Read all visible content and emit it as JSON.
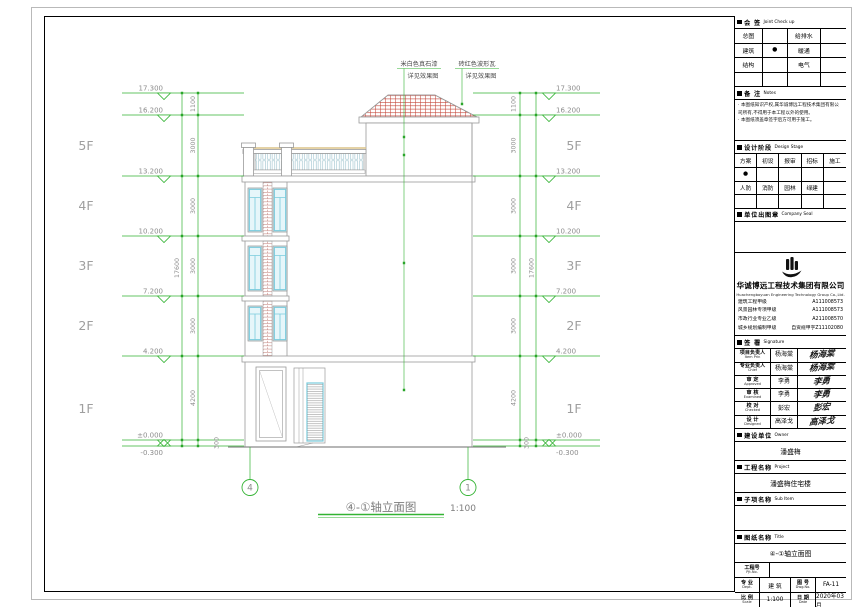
{
  "accent_colors": {
    "dim_green": "#33b333",
    "tile_red": "#c4473a",
    "window_cyan": "#79cbdd",
    "brick_red": "#b2625a"
  },
  "elevation": {
    "levels": [
      "17.300",
      "16.200",
      "13.200",
      "10.200",
      "7.200",
      "4.200",
      "±0.000",
      "-0.300"
    ],
    "floors": [
      "5F",
      "4F",
      "3F",
      "2F",
      "1F"
    ],
    "segments": [
      "1100",
      "3000",
      "3000",
      "3000",
      "3000",
      "4200",
      "300"
    ],
    "total": "17600",
    "axes": [
      "4",
      "1"
    ],
    "notes": [
      {
        "l1": "米白色真石漆",
        "l2": "详见效果图"
      },
      {
        "l1": "砖红色波形瓦",
        "l2": "详见效果图"
      }
    ],
    "title": "④-①轴立面图",
    "scale": "1:100"
  },
  "titleblock": {
    "joint": {
      "cn": "会 签",
      "en": "Joint Check up",
      "rows": [
        [
          "总图",
          "",
          "给排水",
          ""
        ],
        [
          "建筑",
          "●",
          "暖通",
          ""
        ],
        [
          "结构",
          "",
          "电气",
          ""
        ],
        [
          "",
          "",
          "",
          ""
        ]
      ]
    },
    "notes": {
      "cn": "备 注",
      "en": "Notes",
      "items": [
        "· 本图纸知识产权,属华诚博远工程技术集团有限公司所有,不得用于本工程以外的使用。",
        "· 本图纸须盖章签字后方可用于施工。"
      ]
    },
    "stage": {
      "cn": "设计阶段",
      "en": "Design Stage",
      "rows": [
        [
          "方案",
          "初设",
          "报审",
          "招标",
          "施工"
        ],
        [
          "●",
          "",
          "",
          "",
          ""
        ],
        [
          "人防",
          "消防",
          "园林",
          "绿建",
          ""
        ],
        [
          "",
          "",
          "",
          "",
          ""
        ]
      ]
    },
    "seal": {
      "cn": "单位出图章",
      "en": "Company Seal"
    },
    "company": {
      "name_cn": "华诚博远工程技术集团有限公司",
      "name_en": "Huachengboyuan Engineering Technology Group Co.,Ltd.",
      "quals": [
        {
          "label": "建筑工程甲级",
          "code": "A111008573"
        },
        {
          "label": "风景园林专项甲级",
          "code": "A111008573"
        },
        {
          "label": "市政行业专业乙级",
          "code": "A211008570"
        },
        {
          "label": "城乡规划编制甲级",
          "code": "自资规甲字Z11102080"
        }
      ]
    },
    "sign": {
      "cn": "签 署",
      "en": "Signature",
      "rows": [
        {
          "cn": "项目负责人",
          "en": "Item Prin",
          "name": "杨海棠",
          "sig": "杨海棠"
        },
        {
          "cn": "专业负责人",
          "en": "Chief",
          "name": "杨海棠",
          "sig": "杨海棠"
        },
        {
          "cn": "审 定",
          "en": "Approved",
          "name": "李勇",
          "sig": "李勇"
        },
        {
          "cn": "审 核",
          "en": "Examined",
          "name": "李勇",
          "sig": "李勇"
        },
        {
          "cn": "校 对",
          "en": "Checked",
          "name": "彭宏",
          "sig": "彭宏"
        },
        {
          "cn": "设 计",
          "en": "Designed",
          "name": "高泽戈",
          "sig": "高泽戈"
        }
      ]
    },
    "owner": {
      "cn": "建设单位",
      "en": "Owner",
      "value": "潘盛梅"
    },
    "project": {
      "cn": "工程名称",
      "en": "Project",
      "value": "潘盛梅住宅楼"
    },
    "subitem": {
      "cn": "子项名称",
      "en": "Sub Item",
      "value": ""
    },
    "dwgtitle": {
      "cn": "图纸名称",
      "en": "Title",
      "value": "④-①轴立面图"
    },
    "bottom": {
      "pjt_cn": "工程号",
      "pjt_en": "Pjt.No.",
      "pjt_value": "",
      "dept_cn": "专 业",
      "dept_en": "Dept.",
      "dept_value": "建 筑",
      "no_cn": "图 号",
      "no_en": "Dwg.No.",
      "no_value": "FA-11",
      "scale_cn": "比 例",
      "scale_en": "Scale",
      "scale_value": "1:100",
      "date_cn": "日 期",
      "date_en": "Date",
      "date_value": "2020年03月"
    }
  }
}
